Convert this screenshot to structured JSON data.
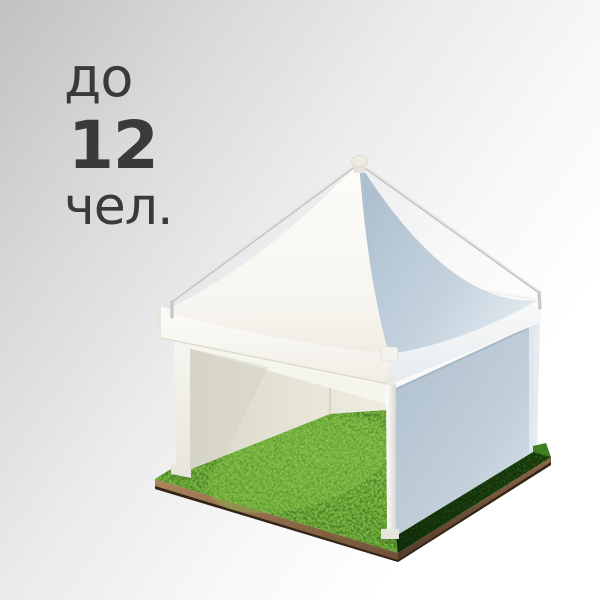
{
  "capacity": {
    "prefix": "до",
    "value": "12",
    "suffix": "чел."
  },
  "illustration": {
    "label": "white pagoda tent with open front on a square grass tile",
    "parts": [
      "peaked-canopy-roof",
      "frame-poles",
      "valance",
      "side-wall",
      "open-front",
      "grass-floor",
      "soil-base"
    ]
  },
  "colors": {
    "text": "#3a3a3a",
    "background_top_left": "#c1c1c3",
    "background_bottom_right": "#ffffff",
    "tent_canvas_white": "#fbfaf7",
    "roof_shaded_blue": "#b4c5d3",
    "wall_shaded_blue": "#b0c0ce",
    "interior_wall_beige": "#e4e3d6",
    "frame_pole_gray": "#cfcfcd",
    "grass_bright_green": "#63ab31",
    "grass_shadow_green": "#1c430f",
    "soil_brown": "#96714e"
  }
}
